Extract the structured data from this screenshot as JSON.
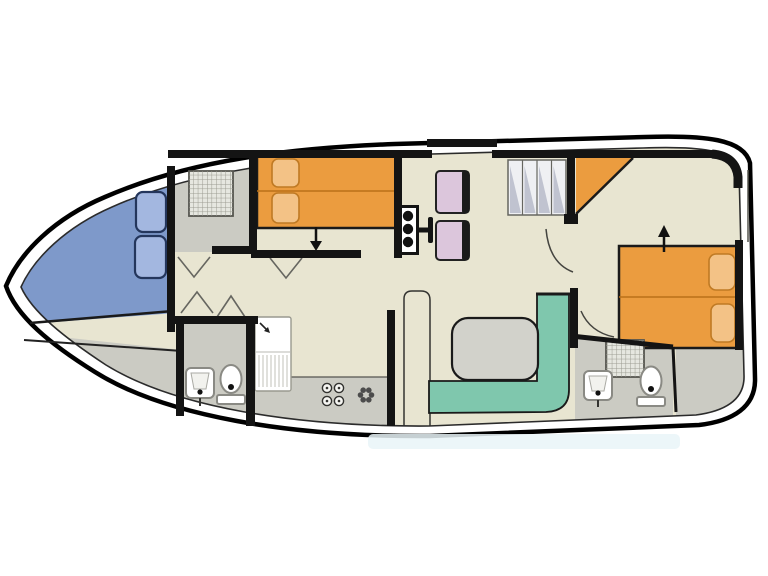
{
  "plan": {
    "description": "Top-view floor plan of a canal cruiser houseboat: pointed bow deck with seating at left, forward twin cabin with en-suite shower room, central saloon with helm seat and dinette, galley, L-shaped settee with table, companionway stairs, and aft double cabin with en-suite bathroom at the stern"
  },
  "colors": {
    "hull_fill": "#ffffff",
    "hull_outline": "#000000",
    "hull_inner_line": "#2b2b2b",
    "wall_black": "#141414",
    "floor_cream": "#e8e5d1",
    "floor_gray": "#cbcbc3",
    "bow_deck_blue": "#7e99ca",
    "cushion_blue": "#a3b7e0",
    "cushion_edge": "#24365c",
    "bed_orange": "#eb9c3f",
    "pillow_orange": "#f3c286",
    "pillow_edge": "#bf7a24",
    "bench_teal": "#7fc7ad",
    "table_gray": "#d2d2cb",
    "chair_pink": "#dcc6dc",
    "chair_back": "#1a1a1a",
    "stairs_bg": "#eff0f3",
    "stairs_shading": "#c0c3d0",
    "shower_bg": "#e6e7e0",
    "fixture_white": "#ffffff",
    "fixture_edge": "#8a8a84",
    "counter_edge": "#555550",
    "door_swing": "#666660",
    "watermark_blue": "#e9f4f8"
  },
  "rooms": [
    {
      "id": "bow-seating-deck"
    },
    {
      "id": "forward-shower-room"
    },
    {
      "id": "forward-cabin"
    },
    {
      "id": "corridor"
    },
    {
      "id": "bathroom-port"
    },
    {
      "id": "galley"
    },
    {
      "id": "saloon-dinette"
    },
    {
      "id": "aft-cabin"
    },
    {
      "id": "aft-bathroom"
    },
    {
      "id": "aft-closet"
    }
  ],
  "fixtures": [
    {
      "id": "bow-cushions",
      "count": 2
    },
    {
      "id": "forward-twin-beds",
      "count": 2
    },
    {
      "id": "helm-console",
      "count": 1
    },
    {
      "id": "dinette-chairs",
      "count": 2
    },
    {
      "id": "saloon-table",
      "count": 1
    },
    {
      "id": "l-shaped-settee",
      "count": 1
    },
    {
      "id": "companionway-stairs",
      "steps": 4
    },
    {
      "id": "corner-wardrobe",
      "count": 1
    },
    {
      "id": "aft-double-bed",
      "count": 1
    },
    {
      "id": "shower-trays",
      "count": 2
    },
    {
      "id": "wash-basins",
      "count": 2
    },
    {
      "id": "toilets",
      "count": 2
    },
    {
      "id": "stove-burners",
      "count": 4
    },
    {
      "id": "extractor-fan",
      "count": 1
    },
    {
      "id": "fridge-sink-unit",
      "count": 1
    },
    {
      "id": "door-swings",
      "count": 4
    }
  ]
}
